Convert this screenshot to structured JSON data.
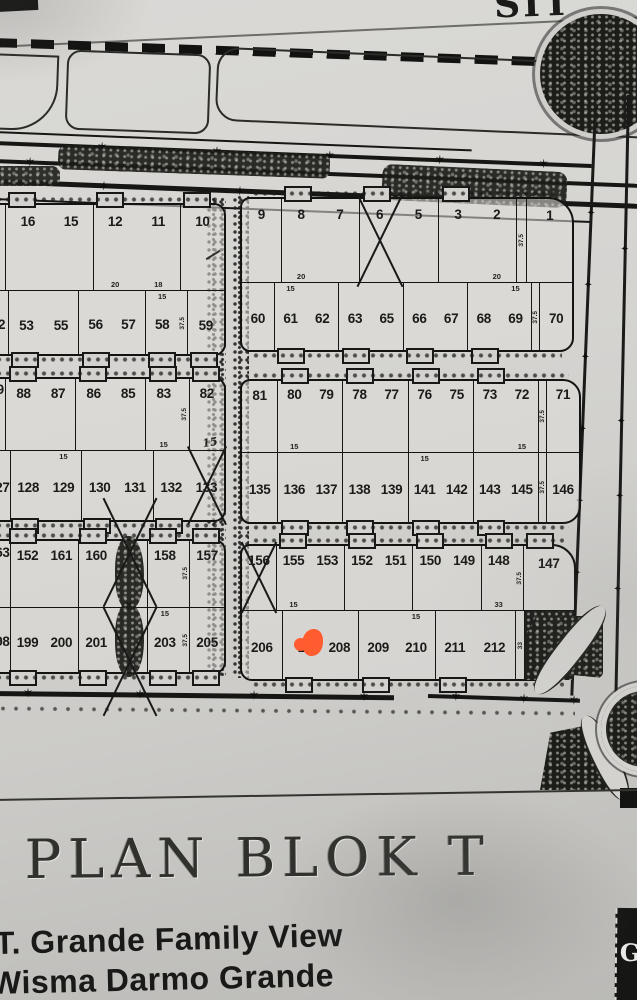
{
  "photo": {
    "top_partial_text": "SIT",
    "sheet_title": "PLAN BLOK T",
    "developer_line1": "T. Grande Family View",
    "developer_line2": "Wisma Darmo Grande",
    "logo_letter": "G",
    "marker_color": "#ff5c2f",
    "ink_color": "#161614"
  },
  "map": {
    "blocks": [
      {
        "name": "block-left-1",
        "left": -14,
        "top": 203,
        "w": 236,
        "h": 149,
        "r": "6px 12px 12px 6px",
        "div": 57,
        "rows": [
          {
            "pos": "top",
            "cells": [
              {
                "type": "spacer",
                "w": 0.4
              },
              {
                "label": "16"
              },
              {
                "label": "15"
              },
              {
                "label": "12",
                "dim": "20"
              },
              {
                "label": "11",
                "dim": "18"
              },
              {
                "label": "10",
                "mark": "slash"
              }
            ]
          },
          {
            "pos": "bottom",
            "cells": [
              {
                "label": "52",
                "w": 0.55
              },
              {
                "label": "53",
                "w": 0.95
              },
              {
                "label": "55",
                "w": 0.95
              },
              {
                "label": "56",
                "w": 0.9
              },
              {
                "label": "57",
                "w": 0.9
              },
              {
                "label": "58",
                "w": 0.9,
                "dim": "15"
              },
              {
                "type": "dimcol",
                "side": "37.5",
                "w": 0.22
              },
              {
                "label": "59"
              }
            ]
          }
        ]
      },
      {
        "name": "block-right-1",
        "left": 240,
        "top": 197,
        "w": 330,
        "h": 151,
        "r": "10px 26px 14px 10px",
        "div": 55,
        "rows": [
          {
            "pos": "top",
            "cells": [
              {
                "label": "9"
              },
              {
                "label": "8",
                "dim": "20"
              },
              {
                "label": "7"
              },
              {
                "label": "6",
                "mark": "x"
              },
              {
                "label": "5"
              },
              {
                "label": "3"
              },
              {
                "label": "2",
                "dim": "20"
              },
              {
                "type": "dimcol",
                "side": "37.5",
                "w": 0.24
              },
              {
                "label": "1",
                "w": 1.15
              }
            ]
          },
          {
            "pos": "bottom",
            "cells": [
              {
                "label": "60"
              },
              {
                "label": "61",
                "dim": "15"
              },
              {
                "label": "62"
              },
              {
                "label": "63"
              },
              {
                "label": "65"
              },
              {
                "label": "66"
              },
              {
                "label": "67"
              },
              {
                "label": "68"
              },
              {
                "label": "69",
                "dim": "15"
              },
              {
                "type": "dimcol",
                "side": "37.5",
                "w": 0.22
              },
              {
                "label": "70"
              }
            ]
          }
        ]
      },
      {
        "name": "block-left-2",
        "left": -14,
        "top": 377,
        "w": 236,
        "h": 141,
        "r": "6px 12px 12px 6px",
        "div": 50,
        "rows": [
          {
            "pos": "top",
            "cells": [
              {
                "label": "89",
                "w": 0.5
              },
              {
                "label": "88"
              },
              {
                "label": "87"
              },
              {
                "label": "86"
              },
              {
                "label": "85"
              },
              {
                "label": "83",
                "dim": "15"
              },
              {
                "type": "dimcol",
                "side": "37.5",
                "w": 0.22
              },
              {
                "label": "82",
                "dim": "15",
                "hand": true
              }
            ]
          },
          {
            "pos": "bottom",
            "cells": [
              {
                "label": "127",
                "w": 0.55
              },
              {
                "label": "128"
              },
              {
                "label": "129",
                "dim": "15"
              },
              {
                "label": "130"
              },
              {
                "label": "131"
              },
              {
                "label": "132"
              },
              {
                "label": "133",
                "mark": "x"
              }
            ]
          }
        ]
      },
      {
        "name": "block-right-2",
        "left": 240,
        "top": 379,
        "w": 337,
        "h": 141,
        "r": "10px 18px 18px 10px",
        "div": 50,
        "rows": [
          {
            "pos": "top",
            "cells": [
              {
                "label": "81",
                "w": 1.1
              },
              {
                "label": "80",
                "dim": "15"
              },
              {
                "label": "79"
              },
              {
                "label": "78"
              },
              {
                "label": "77"
              },
              {
                "label": "76"
              },
              {
                "label": "75"
              },
              {
                "label": "73"
              },
              {
                "label": "72",
                "dim": "15"
              },
              {
                "type": "dimcol",
                "side": "37.5",
                "w": 0.22
              },
              {
                "label": "71"
              }
            ]
          },
          {
            "pos": "bottom",
            "cells": [
              {
                "label": "135",
                "w": 1.1
              },
              {
                "label": "136"
              },
              {
                "label": "137"
              },
              {
                "label": "138"
              },
              {
                "label": "139"
              },
              {
                "label": "141",
                "dim": "15"
              },
              {
                "label": "142"
              },
              {
                "label": "143"
              },
              {
                "label": "145"
              },
              {
                "type": "dimcol",
                "side": "37.5",
                "w": 0.22
              },
              {
                "label": "146"
              }
            ]
          }
        ]
      },
      {
        "name": "block-left-3",
        "left": -14,
        "top": 539,
        "w": 236,
        "h": 131,
        "r": "6px 12px 12px 6px",
        "div": 50,
        "rows": [
          {
            "pos": "top",
            "cells": [
              {
                "label": "163",
                "w": 0.5
              },
              {
                "label": "152"
              },
              {
                "label": "161"
              },
              {
                "label": "160"
              },
              {
                "mark": "scribble",
                "dir": "up"
              },
              {
                "label": "158"
              },
              {
                "type": "dimcol",
                "side": "37.5",
                "w": 0.22
              },
              {
                "label": "157"
              }
            ]
          },
          {
            "pos": "bottom",
            "cells": [
              {
                "label": "198",
                "w": 0.5
              },
              {
                "label": "199"
              },
              {
                "label": "200"
              },
              {
                "label": "201"
              },
              {
                "mark": "scribble",
                "dir": "down"
              },
              {
                "label": "203",
                "dim": "15"
              },
              {
                "type": "dimcol",
                "side": "37.5",
                "w": 0.22
              },
              {
                "label": "205"
              }
            ]
          }
        ]
      },
      {
        "name": "block-right-3",
        "left": 240,
        "top": 544,
        "w": 332,
        "h": 133,
        "r": "10px 24px 22px 12px",
        "div": 48,
        "rows": [
          {
            "pos": "top",
            "cells": [
              {
                "label": "156",
                "mark": "x"
              },
              {
                "label": "155",
                "dim": "15"
              },
              {
                "label": "153"
              },
              {
                "label": "152"
              },
              {
                "label": "151"
              },
              {
                "label": "150"
              },
              {
                "label": "149"
              },
              {
                "label": "148",
                "dim": "33"
              },
              {
                "type": "dimcol",
                "side": "37.5",
                "w": 0.2
              },
              {
                "label": "147",
                "w": 1.5
              }
            ]
          },
          {
            "pos": "bottom",
            "cells": [
              {
                "label": "206",
                "w": 1.05
              },
              {
                "label": "2",
                "mark": "orange"
              },
              {
                "label": "208"
              },
              {
                "label": "209"
              },
              {
                "label": "210",
                "dim": "15"
              },
              {
                "label": "211"
              },
              {
                "label": "212",
                "w": 1.1
              },
              {
                "type": "dimcol",
                "side": "33",
                "w": 0.2
              },
              {
                "type": "garden",
                "w": 1.3
              }
            ]
          }
        ]
      }
    ],
    "road_marker_glyph": "✶",
    "ornament_glyph": "✦"
  }
}
